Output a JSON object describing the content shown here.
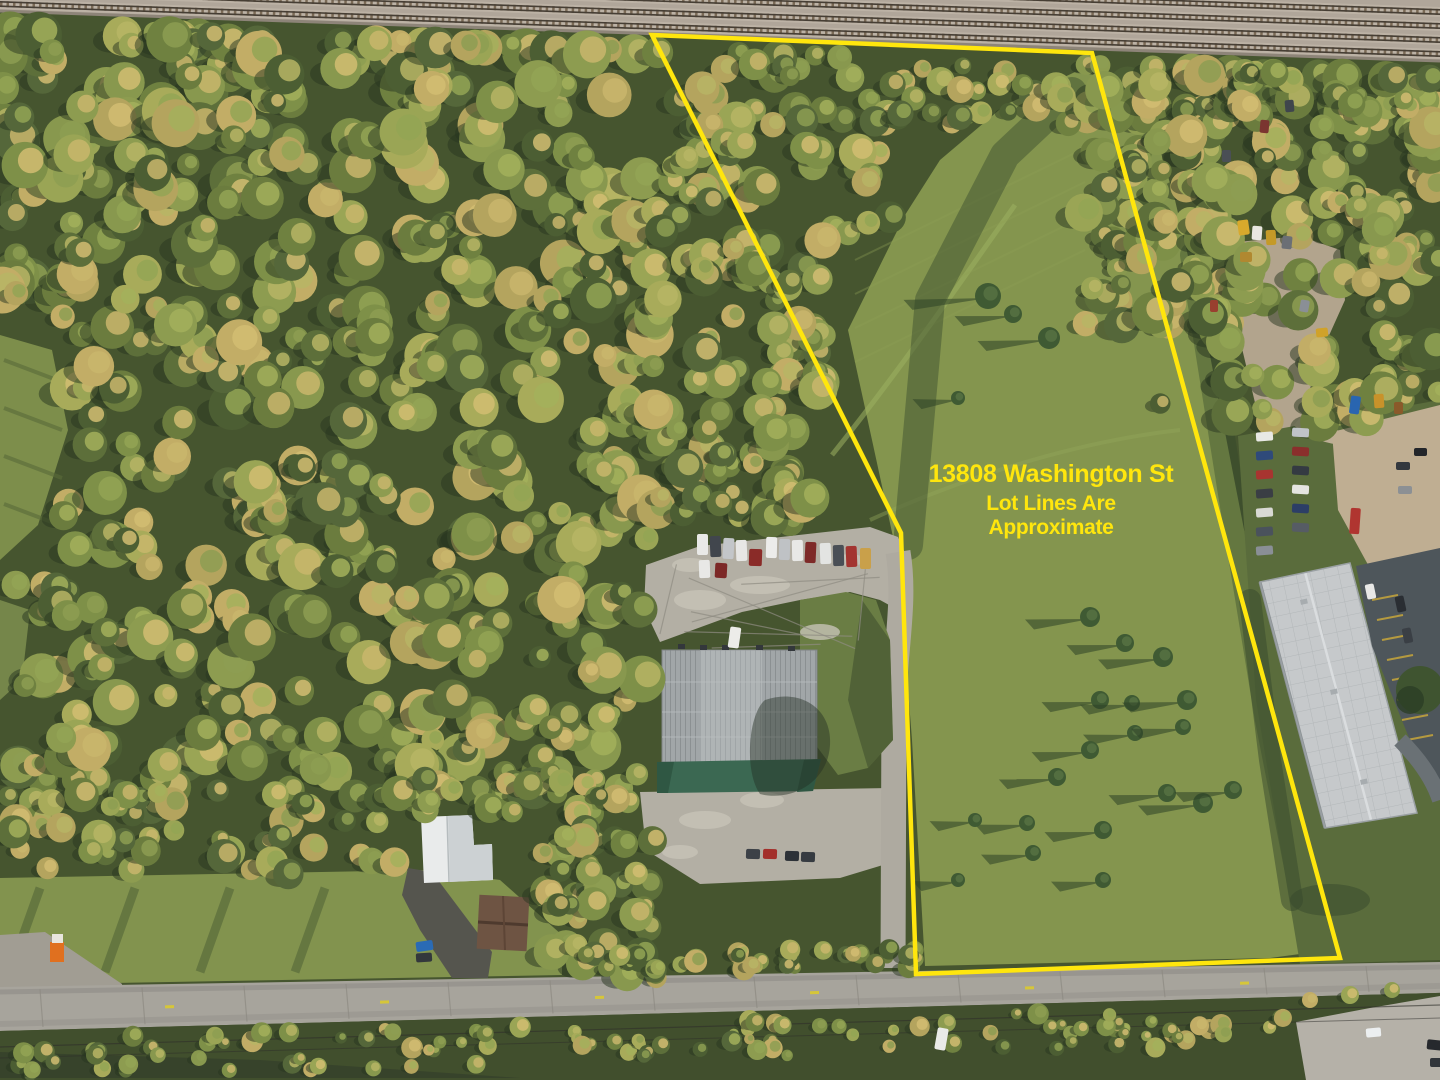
{
  "annotation": {
    "address_line": "13808 Washington St",
    "disclaimer_line1": "Lot Lines Are",
    "disclaimer_line2": "Approximate",
    "text_color": "#FFE60D"
  },
  "lot_boundary": {
    "stroke_color": "#FFE60D",
    "points": "652,35 1092,53 1340,958 916,974 901,533"
  }
}
